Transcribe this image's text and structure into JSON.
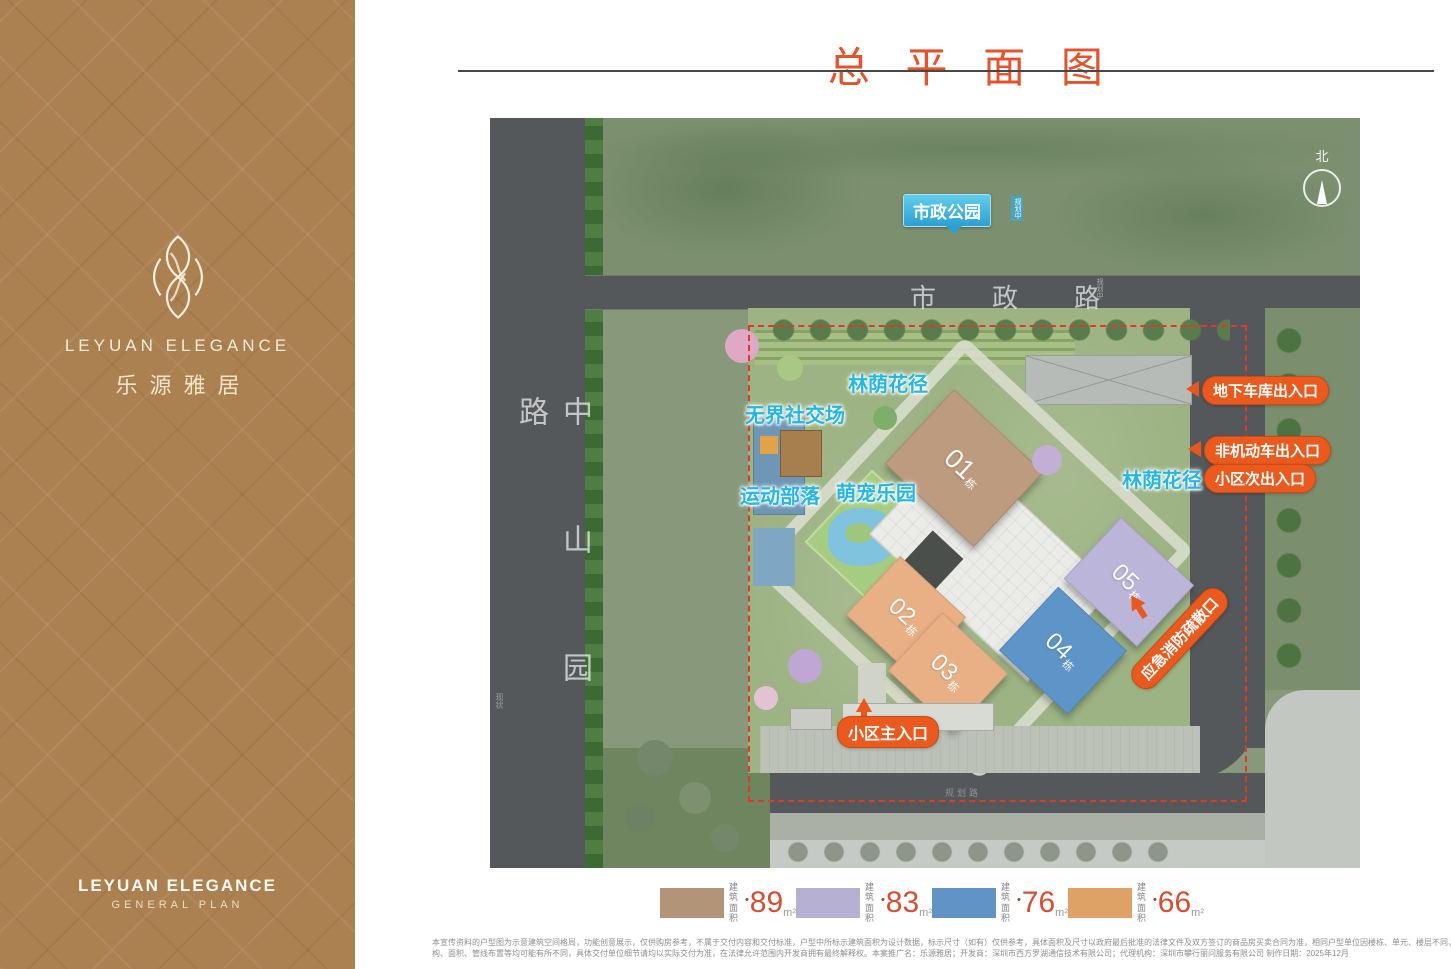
{
  "sidebar": {
    "bg_color": "#ab8151",
    "logo": "leyuan-flower-monogram",
    "brand_en": "LEYUAN ELEGANCE",
    "brand_cn": "乐源雅居",
    "footer_en": "LEYUAN ELEGANCE",
    "footer_sub": "GENERAL PLAN"
  },
  "header": {
    "title": "总平面图",
    "accent_color": "#e4532c"
  },
  "map": {
    "compass": "北",
    "park": {
      "label": "市政公园",
      "annotation": "规划中"
    },
    "roads": {
      "top": {
        "name": "市政路",
        "annotation": "规划中"
      },
      "left": {
        "name": "中山园路",
        "annotation": "现状"
      },
      "bottom": {
        "annotation": "规划路"
      }
    },
    "amenities": {
      "shade_path_north": "林荫花径",
      "social_ground": "无界社交场",
      "sports_zone": "运动部落",
      "pet_park": "萌宠乐园",
      "shade_path_east": "林荫花径"
    },
    "buildings": [
      {
        "no": "01",
        "suffix": "栋",
        "color": "#bd9b7f"
      },
      {
        "no": "02",
        "suffix": "栋",
        "color": "#e9b086"
      },
      {
        "no": "03",
        "suffix": "栋",
        "color": "#e9b086"
      },
      {
        "no": "04",
        "suffix": "栋",
        "color": "#5e95c9"
      },
      {
        "no": "05",
        "suffix": "栋",
        "color": "#bcb5da"
      }
    ],
    "entrances": {
      "garage": "地下车库出入口",
      "non_motor": "非机动车出入口",
      "secondary": "小区次出入口",
      "fire": "应急消防疏散口",
      "main": "小区主入口"
    },
    "boundary_color": "#e0392a"
  },
  "legend": {
    "area_label_top": "建筑",
    "area_label_bottom": "面积",
    "value_color": "#d84c31",
    "items": [
      {
        "color": "#b29478",
        "value": "89",
        "unit": "m²"
      },
      {
        "color": "#b6b1d2",
        "value": "83",
        "unit": "m²"
      },
      {
        "color": "#6193c6",
        "value": "76",
        "unit": "m²"
      },
      {
        "color": "#dfa266",
        "value": "66",
        "unit": "m²"
      }
    ]
  },
  "disclaimer": {
    "line1": "本宣传资料的户型图为示意建筑空间格局，功能创意展示，仅供购房参考，不属于交付内容和交付标准，户型中所标示建筑面积为设计数据，标示尺寸（如有）仅供参考，具体面积及尺寸以政府最后批准的法律文件及双方签订的商品房买卖合同为准，相同户型单位因楼栋、单元、楼层不同，局部结",
    "line2": "构、面积、管线布置等均可能有所不同，具体交付单位细节请均以实际交付为准，在法律允许范围内开发商拥有最终解释权。本案推广名：乐源雅居；开发商：深圳市西方罗湖通信技术有限公司；代理机构：深圳市攀行丽问服务有限公司 制作日期：2025年12月"
  }
}
